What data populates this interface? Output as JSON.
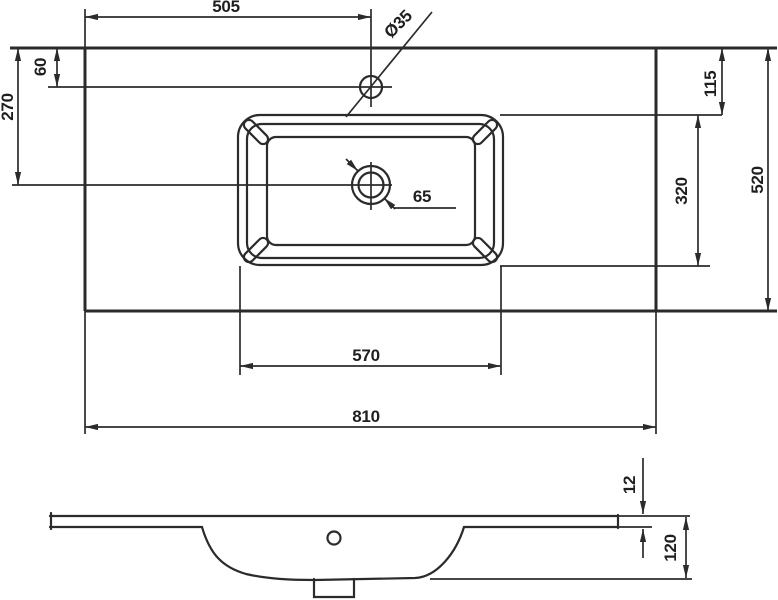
{
  "drawing": {
    "background": "#ffffff",
    "line_color": "#2b2b2b",
    "subject": "washbasin countertop dimension drawing",
    "top_view": {
      "faucet_center_from_left": "505",
      "faucet_hole_diameter": "Ø35",
      "faucet_center_from_back": "60",
      "drain_center_from_back": "270",
      "basin_inset_from_back": "115",
      "total_depth": "520",
      "basin_depth": "320",
      "drain_hole_diameter": "65",
      "basin_width": "570",
      "total_width": "810"
    },
    "side_view": {
      "slab_thickness": "12",
      "total_height": "120"
    }
  }
}
